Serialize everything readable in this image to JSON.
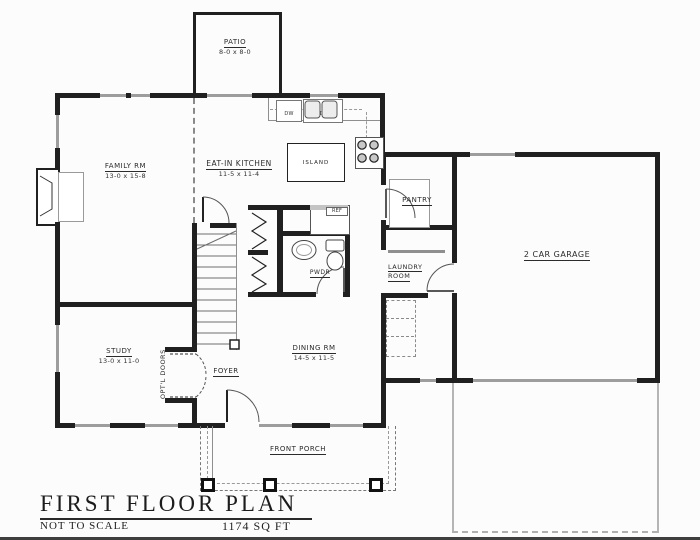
{
  "plan": {
    "rooms": {
      "patio": {
        "name": "PATIO",
        "dims": "8-0 x 8-0"
      },
      "family": {
        "name": "FAMILY RM",
        "dims": "13-0 x 15-8"
      },
      "kitchen": {
        "name": "EAT-IN KITCHEN",
        "dims": "11-5 x 11-4"
      },
      "island": {
        "name": "ISLAND"
      },
      "pantry": {
        "name": "PANTRY"
      },
      "laundry": {
        "name_line1": "LAUNDRY",
        "name_line2": "ROOM"
      },
      "garage": {
        "name": "2 CAR GARAGE"
      },
      "study": {
        "name": "STUDY",
        "dims": "13-0 x 11-0"
      },
      "dining": {
        "name": "DINING RM",
        "dims": "14-5 x 11-5"
      },
      "foyer": {
        "name": "FOYER"
      },
      "powder": {
        "name": "PWDR"
      },
      "porch": {
        "name": "FRONT PORCH"
      }
    },
    "annotations": {
      "optional_doors": "OPT'L DOORS",
      "dishwasher": "DW",
      "disposal": "DISP",
      "refrigerator": "REF"
    },
    "titleblock": {
      "title": "FIRST FLOOR PLAN",
      "scale_note": "NOT TO SCALE",
      "area": "1174 SQ FT"
    }
  }
}
